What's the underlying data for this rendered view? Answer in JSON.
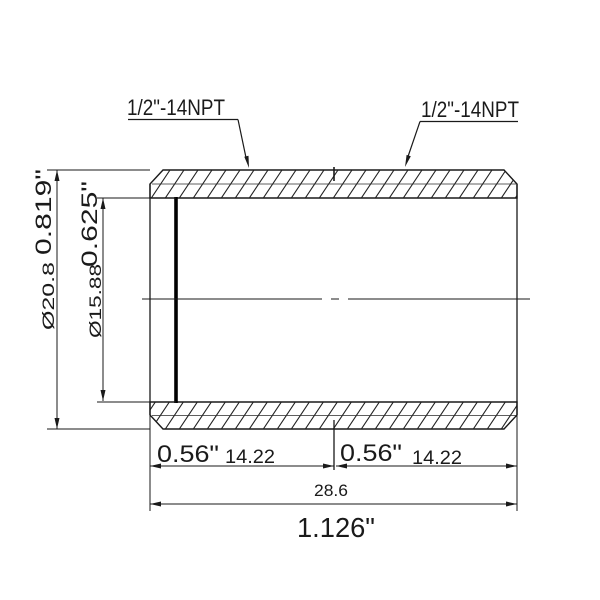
{
  "drawing": {
    "type": "technical-drawing",
    "subject": "threaded pipe nipple cross-section",
    "colors": {
      "line": "#1a1a1a",
      "background": "#ffffff"
    },
    "thread_spec_left": "1/2\"-14NPT",
    "thread_spec_right": "1/2\"-14NPT",
    "dimensions": {
      "outer_diameter": {
        "mm": "Ø20.8",
        "inch": "0.819\""
      },
      "inner_diameter": {
        "mm": "Ø15.88",
        "inch": "0.625\""
      },
      "thread_length_left": {
        "inch": "0.56\"",
        "mm": "14.22"
      },
      "thread_length_right": {
        "inch": "0.56\"",
        "mm": "14.22"
      },
      "overall_length": {
        "mm": "28.6",
        "inch": "1.126\""
      }
    }
  }
}
